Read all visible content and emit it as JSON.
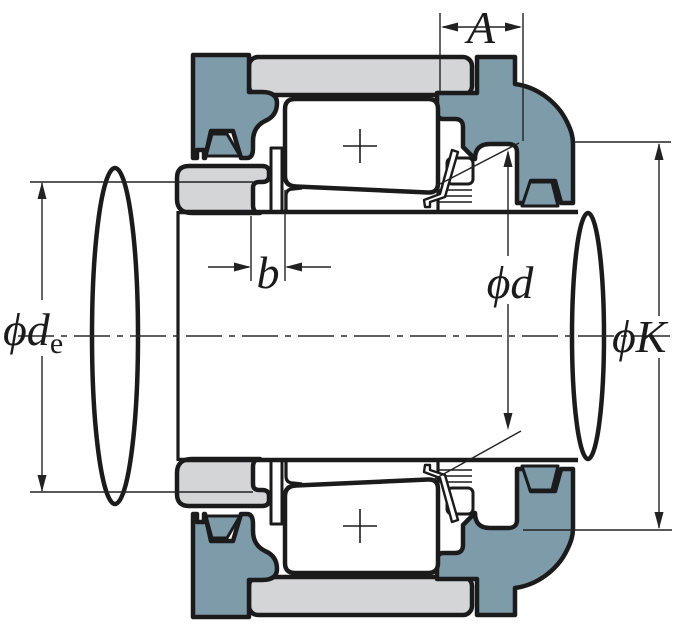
{
  "diagram": {
    "type": "bearing-mounting-cross-section",
    "description": "Cross-section of a spherical roller bearing mounted with a sleeve and locknut in a housing on a stepped shaft, with dimension callouts"
  },
  "labels": {
    "width_a": "A",
    "width_b": "b",
    "shaft_diameter": "ϕd",
    "shaft_end_diameter_main": "ϕd",
    "shaft_end_diameter_sub": "e",
    "housing_spigot_diameter": "ϕK"
  },
  "colors": {
    "housing": "#7E9BAA",
    "ring": "#D3D5D7",
    "outline": "#1B1B1B",
    "dim": "#222222",
    "background": "#FFFFFF"
  }
}
